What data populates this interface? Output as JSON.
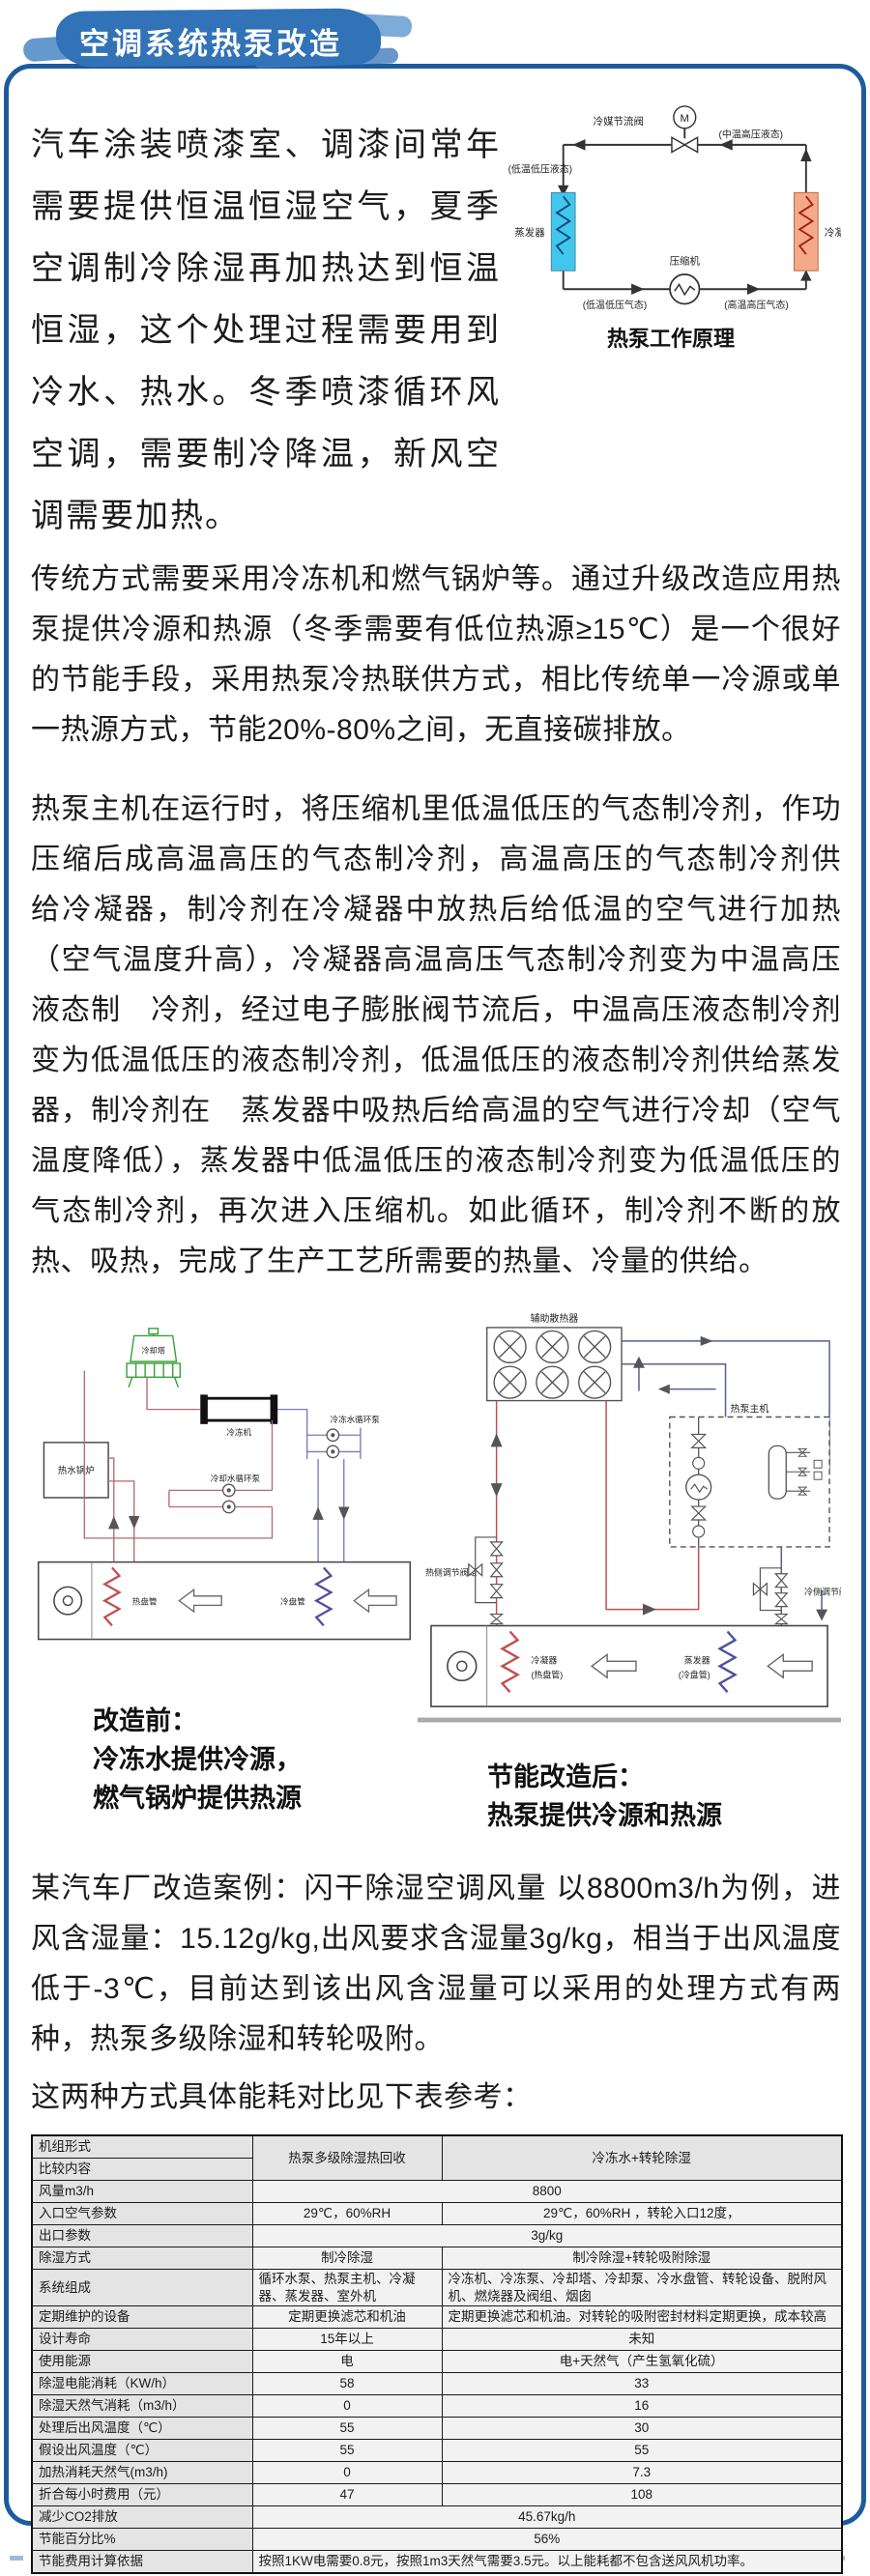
{
  "page": {
    "title": "空调系统热泵改造"
  },
  "intro": {
    "p1": "汽车涂装喷漆室、调漆间常年需要提供恒温恒湿空气，夏季空调制冷除湿再加热达到恒温恒湿，这个处理过程需要用到冷水、热水。冬季喷漆循环风空调，需要制冷降温，新风空调需要加热。",
    "p2": "传统方式需要采用冷冻机和燃气锅炉等。通过升级改造应用热泵提供冷源和热源（冬季需要有低位热源≥15℃）是一个很好的节能手段，采用热泵冷热联供方式，相比传统单一冷源或单一热源方式，节能20%-80%之间，无直接碳排放。",
    "p3": "热泵主机在运行时，将压缩机里低温低压的气态制冷剂，作功压缩后成高温高压的气态制冷剂，高温高压的气态制冷剂供　给冷凝器，制冷剂在冷凝器中放热后给低温的空气进行加热（空气温度升高），冷凝器高温高压气态制冷剂变为中温高压液态制　冷剂，经过电子膨胀阀节流后，中温高压液态制冷剂变为低温低压的液态制冷剂，低温低压的液态制冷剂供给蒸发器，制冷剂在　蒸发器中吸热后给高温的空气进行冷却（空气温度降低），蒸发器中低温低压的液态制冷剂变为低温低压的气态制冷剂，再次进入压缩机。如此循环，制冷剂不断的放热、吸热，完成了生产工艺所需要的热量、冷量的供给。"
  },
  "principle_diagram": {
    "caption": "热泵工作原理",
    "labels": {
      "throttle_valve": "冷媒节流阀",
      "motor": "M",
      "mid_liquid": "(中温高压液态)",
      "low_liquid": "(低温低压液态)",
      "evaporator": "蒸发器",
      "condenser": "冷凝器",
      "compressor": "压缩机",
      "low_gas": "(低温低压气态)",
      "high_gas": "(高温高压气态)"
    }
  },
  "before_diagram": {
    "labels": {
      "cooling_tower": "冷却塔",
      "boiler": "热水锅炉",
      "chiller": "冷冻机",
      "chilled_pump": "冷冻水循环泵",
      "cooling_pump": "冷却水循环泵",
      "hot_coil": "热盘管",
      "cold_coil": "冷盘管"
    },
    "caption_line1": "改造前：",
    "caption_line2": "冷冻水提供冷源，",
    "caption_line3": "燃气锅炉提供热源"
  },
  "after_diagram": {
    "labels": {
      "aux_radiator": "辅助散热器",
      "heat_pump_unit": "热泵主机",
      "hot_valve_group": "热侧调节阀组",
      "cold_valve_group": "冷侧调节阀组",
      "condenser_coil_1": "冷凝器",
      "condenser_coil_2": "(热盘管)",
      "evaporator_coil_1": "蒸发器",
      "evaporator_coil_2": "(冷盘管)"
    },
    "caption_line1": "节能改造后：",
    "caption_line2": "热泵提供冷源和热源"
  },
  "case": {
    "p4": "某汽车厂改造案例：闪干除湿空调风量 以8800m3/h为例，进风含湿量：15.12g/kg,出风要求含湿量3g/kg，相当于出风温度低于-3℃，目前达到该出风含湿量可以采用的处理方式有两种，热泵多级除湿和转轮吸附。",
    "p5": "这两种方式具体能耗对比见下表参考："
  },
  "table": {
    "header": {
      "label_top": "机组形式",
      "label_bottom": "比较内容",
      "col1": "热泵多级除湿热回收",
      "col2": "冷冻水+转轮除湿"
    },
    "rows": [
      {
        "label": "风量m3/h",
        "value": "8800"
      },
      {
        "label": "入口空气参数",
        "col1": "29℃，60%RH",
        "col2": "29℃，60%RH ，转轮入口12度，"
      },
      {
        "label": "出口参数",
        "value": "3g/kg"
      },
      {
        "label": "除湿方式",
        "col1": "制冷除湿",
        "col2": "制冷除湿+转轮吸附除湿"
      },
      {
        "label": "系统组成",
        "col1": "循环水泵、热泵主机、冷凝器、蒸发器、室外机",
        "col2": "冷冻机、冷冻泵、冷却塔、冷却泵、冷水盘管、转轮设备、脱附风机、燃烧器及阀组、烟囱"
      },
      {
        "label": "定期维护的设备",
        "col1": "定期更换滤芯和机油",
        "col2": "定期更换滤芯和机油。对转轮的吸附密封材料定期更换，成本较高"
      },
      {
        "label": "设计寿命",
        "col1": "15年以上",
        "col2": "未知"
      },
      {
        "label": "使用能源",
        "col1": "电",
        "col2": "电+天然气（产生氢氧化硫）"
      },
      {
        "label": "除湿电能消耗（KW/h）",
        "col1": "58",
        "col2": "33"
      },
      {
        "label": "除湿天然气消耗（m3/h）",
        "col1": "0",
        "col2": "16"
      },
      {
        "label": "处理后出风温度（℃）",
        "col1": "55",
        "col2": "30"
      },
      {
        "label": "假设出风温度（℃）",
        "col1": "55",
        "col2": "55"
      },
      {
        "label": "加热消耗天然气(m3/h)",
        "col1": "0",
        "col2": "7.3"
      },
      {
        "label": "折合每小时费用（元）",
        "col1": "47",
        "col2": "108"
      },
      {
        "label": "减少CO2排放",
        "value": "45.67kg/h"
      },
      {
        "label": "节能百分比%",
        "value": "56%"
      },
      {
        "label": "节能费用计算依据",
        "value": "按照1KW电需要0.8元，按照1m3天然气需要3.5元。以上能耗都不包含送风风机功率。"
      }
    ]
  }
}
